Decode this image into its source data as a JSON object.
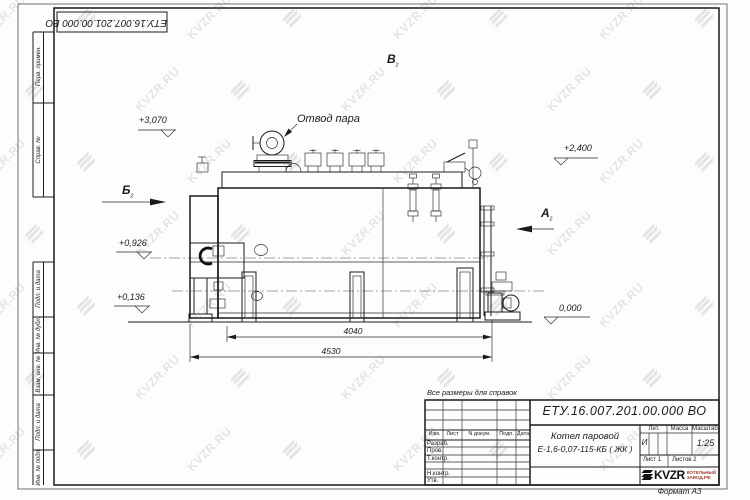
{
  "sheet": {
    "format_note": "Формат А3",
    "reference_note": "Все размеры для справок",
    "top_designation": "ЕТУ.16.007.201.00.000  ВО",
    "side_labels": [
      "Перв. примен.",
      "Справ. №",
      "Подп. и дата",
      "Инв. № дубл.",
      "Взам. инв. №",
      "Подп. и дата",
      "Инв. № подл."
    ]
  },
  "watermark": {
    "text": "KVZR.RU"
  },
  "title_block": {
    "designation": "ЕТУ.16.007.201.00.000  ВО",
    "product_name_line1": "Котел паровой",
    "product_name_line2": "Е-1,6-0,07-115-КБ ( ЖК )",
    "header_cells": [
      "Изм.",
      "Лист",
      "N докум.",
      "Подп.",
      "Дата"
    ],
    "row_labels": [
      "Разраб.",
      "Пров.",
      "Т.контр.",
      "",
      "Н.контр.",
      "Утв."
    ],
    "lit_label": "Лит.",
    "lit_value": "И",
    "mass_label": "Масса",
    "mass_value": "",
    "scale_label": "Масштаб",
    "scale_value": "1:25",
    "sheet_label": "Лист",
    "sheet_value": "1",
    "sheets_label": "Листов",
    "sheets_value": "2",
    "logo_text": "KVZR",
    "logo_caption_line1": "КОТЕЛЬНЫЙ",
    "logo_caption_line2": "ЗАВОД.РФ"
  },
  "annotations": {
    "steam_outlet_label": "Отвод пара",
    "elevations": {
      "steam_outlet": "+3,070",
      "drum_top": "+2,400",
      "burner_axis": "+0,926",
      "bottom_fitting": "+0,136",
      "floor": "0,000"
    },
    "views": {
      "view_b": {
        "letter": "Б",
        "sheet_ref": "2"
      },
      "view_v": {
        "letter": "В",
        "sheet_ref": "2"
      },
      "view_a": {
        "letter": "А",
        "sheet_ref": "2"
      }
    },
    "dimensions": {
      "boiler_length": "4040",
      "overall_length": "4530"
    }
  }
}
